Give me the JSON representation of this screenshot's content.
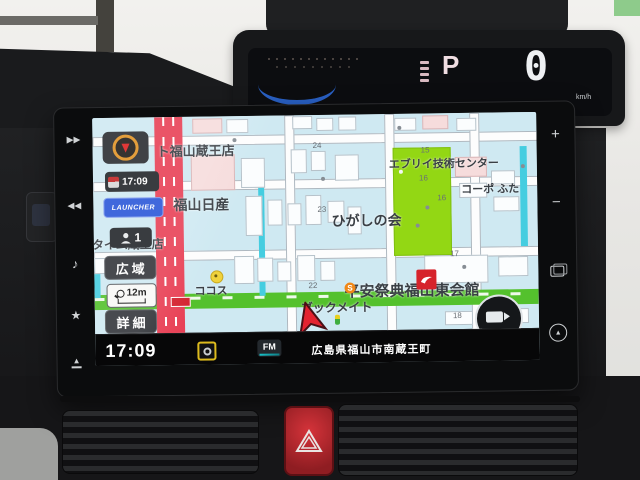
{
  "cluster": {
    "gear_indicator": "P",
    "speed_value": "0",
    "speed_unit": "km/h"
  },
  "nav_unit": {
    "bezel": {
      "next": "▶▶",
      "prev": "◀◀",
      "music": "♪",
      "favorite": "★",
      "eject": "▲",
      "volume_up": "+",
      "volume_down": "−",
      "home": "▲"
    },
    "sidebar": {
      "vics_time": "17:09",
      "launcher_label": "LAUNCHER",
      "passenger_count": "1",
      "wide_area_label": "広域",
      "map_scale": "12m",
      "detail_label": "詳細"
    },
    "map": {
      "labels": [
        {
          "text": "ト福山蔵王店"
        },
        {
          "text": "福山日産"
        },
        {
          "text": "タイム蔵王店"
        },
        {
          "text": "ひがしの会"
        },
        {
          "text": "エブリイ技術センター"
        },
        {
          "text": "コーポ ふた"
        },
        {
          "text": "平安祭典福山東会館"
        },
        {
          "text": "ブックメイト"
        },
        {
          "text": "ココス"
        }
      ],
      "s_icon": "S",
      "block_numbers": [
        "15",
        "16",
        "16",
        "17",
        "18",
        "22",
        "23",
        "24"
      ]
    },
    "status_bar": {
      "time": "17:09",
      "source_label": "FM",
      "location": "広島県福山市南蔵王町"
    },
    "colors": {
      "map_bg": "#cfe9f2",
      "road_major": "#e84156",
      "road_green": "#54c12d",
      "field_green": "#93d714",
      "water_cyan": "#45cde0",
      "launcher_blue": "#2b57d8",
      "accent_yellow": "#ddbb1e",
      "logo_red": "#d6232b"
    }
  }
}
